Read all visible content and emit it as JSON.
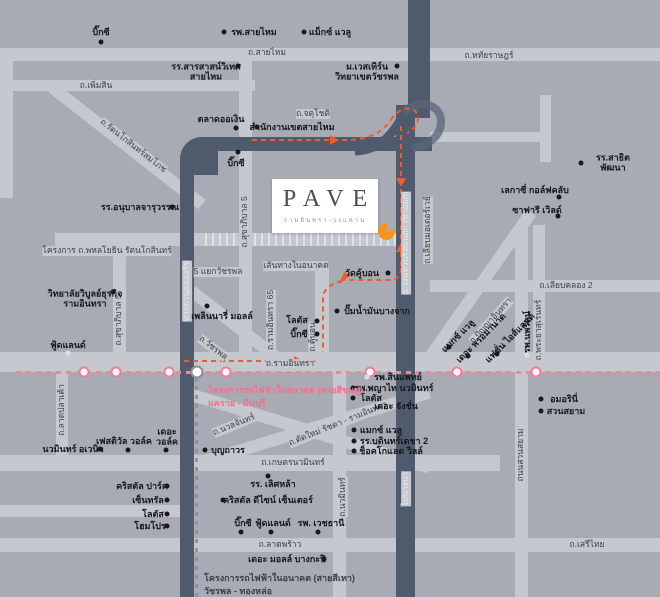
{
  "logo": {
    "brand": "PAVE",
    "subtitle": "รามอินทรา-วงแหวน"
  },
  "colors": {
    "background": "#a9abb4",
    "light_road": "#c5c8ce",
    "dark_road": "#4f5b6c",
    "pink_line": "#f2849b",
    "orange_route": "#f15a29",
    "project_marker": "#f7941e"
  },
  "future_route": {
    "label": "เส้นทางในอนาคต"
  },
  "pink_line": {
    "label": "โครงการรถไฟฟ้าในอนาคต (สายสีชมพู)",
    "label2": "แคราย - มีนบุรี",
    "stations": [
      84,
      116,
      169,
      226,
      370,
      457,
      536
    ],
    "interchange_station": {
      "x": 197,
      "y": 372
    }
  },
  "grey_line": {
    "label": "โครงการรถไฟฟ้าในอนาคต (สายสีเทา)",
    "label2": "วัชรพล - ทองหล่อ"
  },
  "road_labels": [
    {
      "t": "ถ.สายไหม",
      "x": 267,
      "y": 53
    },
    {
      "t": "ถ.หทัยราษฎร์",
      "x": 489,
      "y": 56
    },
    {
      "t": "ถ.เพิ่มสิน",
      "x": 96,
      "y": 86
    },
    {
      "t": "ถ.จตุโชติ",
      "x": 313,
      "y": 114
    },
    {
      "t": "ถ.รัตนโกสินทร์สมโภช",
      "x": 133,
      "y": 146,
      "r": 38
    },
    {
      "t": "โครงการ ถ.พหลโยธิน รัตนโกสินทร์",
      "x": 107,
      "y": 251
    },
    {
      "t": "5 แยกวัชรพล",
      "x": 218,
      "y": 272
    },
    {
      "t": "ถ.สุขาภิบาล 5",
      "x": 119,
      "y": 320,
      "r": -90
    },
    {
      "t": "ถ.สุขาภิบาล 5",
      "x": 245,
      "y": 222,
      "r": -90
    },
    {
      "t": "ถ.รามอินทรา 65",
      "x": 271,
      "y": 320,
      "r": -90
    },
    {
      "t": "ถ.คู้บอน",
      "x": 313,
      "y": 337,
      "r": -90
    },
    {
      "t": "ถ.วัชรพล",
      "x": 213,
      "y": 348,
      "r": 38
    },
    {
      "t": "ถ.รามอินทรา",
      "x": 290,
      "y": 364
    },
    {
      "t": "ถ.นวลจันทร์",
      "x": 234,
      "y": 425,
      "r": -22
    },
    {
      "t": "ถ.ตัดใหม่ รัชดา - รามอินทรา",
      "x": 338,
      "y": 424,
      "r": -22
    },
    {
      "t": "ถ.เกษตรนวมินทร์",
      "x": 293,
      "y": 463
    },
    {
      "t": "ถ.นวมินทร์",
      "x": 343,
      "y": 497,
      "r": -90
    },
    {
      "t": "ถ.ลาดปลาเค้า",
      "x": 62,
      "y": 410,
      "r": -90
    },
    {
      "t": "ถ.ลาดพร้าว",
      "x": 280,
      "y": 545
    },
    {
      "t": "ถ.เสรีไทย",
      "x": 587,
      "y": 545
    },
    {
      "t": "ถนนสวนสยาม",
      "x": 521,
      "y": 455,
      "r": -90
    },
    {
      "t": "ถ.พระยาสุเรนทร์",
      "x": 539,
      "y": 330,
      "r": -90
    },
    {
      "t": "ถ.ปัญญาอินทรา",
      "x": 491,
      "y": 321,
      "r": -48
    },
    {
      "t": "ถ.เลียบคลอง 2",
      "x": 566,
      "y": 286
    },
    {
      "t": "ถ.เลียบมอเตอร์เวย์",
      "x": 428,
      "y": 230,
      "r": -90
    },
    {
      "t": "ทางด่วนฉลองรัช",
      "x": 187,
      "y": 291,
      "r": -90,
      "w": true
    },
    {
      "t": "ถ.วงแหวนรอบนอก (ขาออก)",
      "x": 406,
      "y": 243,
      "r": -90,
      "w": true
    },
    {
      "t": "ไปบางนา",
      "x": 406,
      "y": 489,
      "r": -90,
      "w": true
    }
  ],
  "poi_labels": [
    {
      "t": "บิ๊กซี",
      "x": 101,
      "y": 32
    },
    {
      "t": "รพ.สายไหม",
      "x": 254,
      "y": 32
    },
    {
      "t": "แม็กซ์ แวลู",
      "x": 330,
      "y": 32
    },
    {
      "t": "รร.สารสาสน์วิเทศ\nสายไหม",
      "x": 206,
      "y": 72
    },
    {
      "t": "ม.เวสเทิร์น\nวิทยาเขตวัชรพล",
      "x": 367,
      "y": 72
    },
    {
      "t": "ตลาดออเงิน",
      "x": 221,
      "y": 119
    },
    {
      "t": "สำนักงานเขตสายไหม",
      "x": 292,
      "y": 127
    },
    {
      "t": "บิ๊กซี",
      "x": 236,
      "y": 163
    },
    {
      "t": "รร.สาธิตพัฒนา",
      "x": 613,
      "y": 163
    },
    {
      "t": "เลกาซี่ กอล์ฟคลับ",
      "x": 535,
      "y": 190
    },
    {
      "t": "ซาฟารี เวิลด์",
      "x": 537,
      "y": 210
    },
    {
      "t": "รร.อนุบาลจารุวรรณ",
      "x": 140,
      "y": 207
    },
    {
      "t": "วิทยาลัยวิบูลย์ธุรกิจ\nรามอินทรา",
      "x": 85,
      "y": 299
    },
    {
      "t": "เพลินนารี่ มอลล์",
      "x": 222,
      "y": 316
    },
    {
      "t": "ฟู้ดแลนด์",
      "x": 68,
      "y": 345
    },
    {
      "t": "ปั๊มน้ำมันบางจาก",
      "x": 377,
      "y": 311
    },
    {
      "t": "โลตัส",
      "x": 297,
      "y": 320
    },
    {
      "t": "บิ๊กซี",
      "x": 299,
      "y": 334
    },
    {
      "t": "วัดคู้บอน",
      "x": 362,
      "y": 273
    },
    {
      "t": "แมกซ์ แวลู",
      "x": 458,
      "y": 336,
      "r": -45
    },
    {
      "t": "เดอะ พรอมานาด",
      "x": 481,
      "y": 338,
      "r": -45
    },
    {
      "t": "แฟชั่น ไอส์แลนด์",
      "x": 510,
      "y": 338,
      "r": -45
    },
    {
      "t": "รพ.นพรัตน์",
      "x": 527,
      "y": 332,
      "r": -90
    },
    {
      "t": "รพ.สินแพทย์",
      "x": 398,
      "y": 377
    },
    {
      "t": "รพ.พญาไท นวมินทร์",
      "x": 394,
      "y": 388
    },
    {
      "t": "โลตัส",
      "x": 371,
      "y": 398
    },
    {
      "t": "เดอะ จังชั่น",
      "x": 396,
      "y": 406
    },
    {
      "t": "แมกซ์ แวลู",
      "x": 381,
      "y": 430
    },
    {
      "t": "รร.บดินทร์เดชา 2",
      "x": 394,
      "y": 441
    },
    {
      "t": "ช็อคโกแลต วิลล์",
      "x": 391,
      "y": 451
    },
    {
      "t": "บุญถาวร",
      "x": 228,
      "y": 450
    },
    {
      "t": "นวมินทร์ อเวนิว",
      "x": 73,
      "y": 449
    },
    {
      "t": "เฟสติวัล วอล์ค",
      "x": 124,
      "y": 441
    },
    {
      "t": "เดอะ\nวอล์ค",
      "x": 167,
      "y": 437
    },
    {
      "t": "คริสตัล ปาร์ค",
      "x": 142,
      "y": 486
    },
    {
      "t": "เซ็นทรัล",
      "x": 148,
      "y": 500
    },
    {
      "t": "โลตัส",
      "x": 153,
      "y": 514
    },
    {
      "t": "โฮมโปร",
      "x": 150,
      "y": 526
    },
    {
      "t": "คริสตัล ดีไซน์ เซ็นเตอร์",
      "x": 268,
      "y": 500
    },
    {
      "t": "รร. เลิศหล้า",
      "x": 273,
      "y": 484
    },
    {
      "t": "บิ๊กซี",
      "x": 243,
      "y": 523
    },
    {
      "t": "ฟู้ดแลนด์",
      "x": 273,
      "y": 523
    },
    {
      "t": "รพ. เวชธานี",
      "x": 321,
      "y": 523
    },
    {
      "t": "เดอะ มอลล์ บางกะปิ",
      "x": 287,
      "y": 559
    },
    {
      "t": "อมอรินี่",
      "x": 564,
      "y": 399
    },
    {
      "t": "สวนสยาม",
      "x": 566,
      "y": 411
    }
  ],
  "markers": [
    {
      "x": 101,
      "y": 42
    },
    {
      "x": 224,
      "y": 32
    },
    {
      "x": 304,
      "y": 32
    },
    {
      "x": 238,
      "y": 66
    },
    {
      "x": 397,
      "y": 66
    },
    {
      "x": 236,
      "y": 128
    },
    {
      "x": 257,
      "y": 127
    },
    {
      "x": 238,
      "y": 152
    },
    {
      "x": 581,
      "y": 163
    },
    {
      "x": 559,
      "y": 197
    },
    {
      "x": 558,
      "y": 216
    },
    {
      "x": 172,
      "y": 207
    },
    {
      "x": 113,
      "y": 292
    },
    {
      "x": 207,
      "y": 306
    },
    {
      "x": 68,
      "y": 353,
      "light": true
    },
    {
      "x": 337,
      "y": 311
    },
    {
      "x": 317,
      "y": 321
    },
    {
      "x": 317,
      "y": 334
    },
    {
      "x": 388,
      "y": 273
    },
    {
      "x": 449,
      "y": 347
    },
    {
      "x": 468,
      "y": 356
    },
    {
      "x": 497,
      "y": 354
    },
    {
      "x": 527,
      "y": 355,
      "light": true
    },
    {
      "x": 367,
      "y": 377,
      "light": true
    },
    {
      "x": 353,
      "y": 388
    },
    {
      "x": 353,
      "y": 398
    },
    {
      "x": 354,
      "y": 430
    },
    {
      "x": 354,
      "y": 441
    },
    {
      "x": 354,
      "y": 451
    },
    {
      "x": 205,
      "y": 450
    },
    {
      "x": 100,
      "y": 449
    },
    {
      "x": 128,
      "y": 450
    },
    {
      "x": 166,
      "y": 450
    },
    {
      "x": 167,
      "y": 486
    },
    {
      "x": 167,
      "y": 500
    },
    {
      "x": 167,
      "y": 514
    },
    {
      "x": 167,
      "y": 526
    },
    {
      "x": 223,
      "y": 500
    },
    {
      "x": 268,
      "y": 476
    },
    {
      "x": 241,
      "y": 532
    },
    {
      "x": 271,
      "y": 532
    },
    {
      "x": 318,
      "y": 532
    },
    {
      "x": 324,
      "y": 559
    },
    {
      "x": 541,
      "y": 399
    },
    {
      "x": 541,
      "y": 411
    }
  ]
}
